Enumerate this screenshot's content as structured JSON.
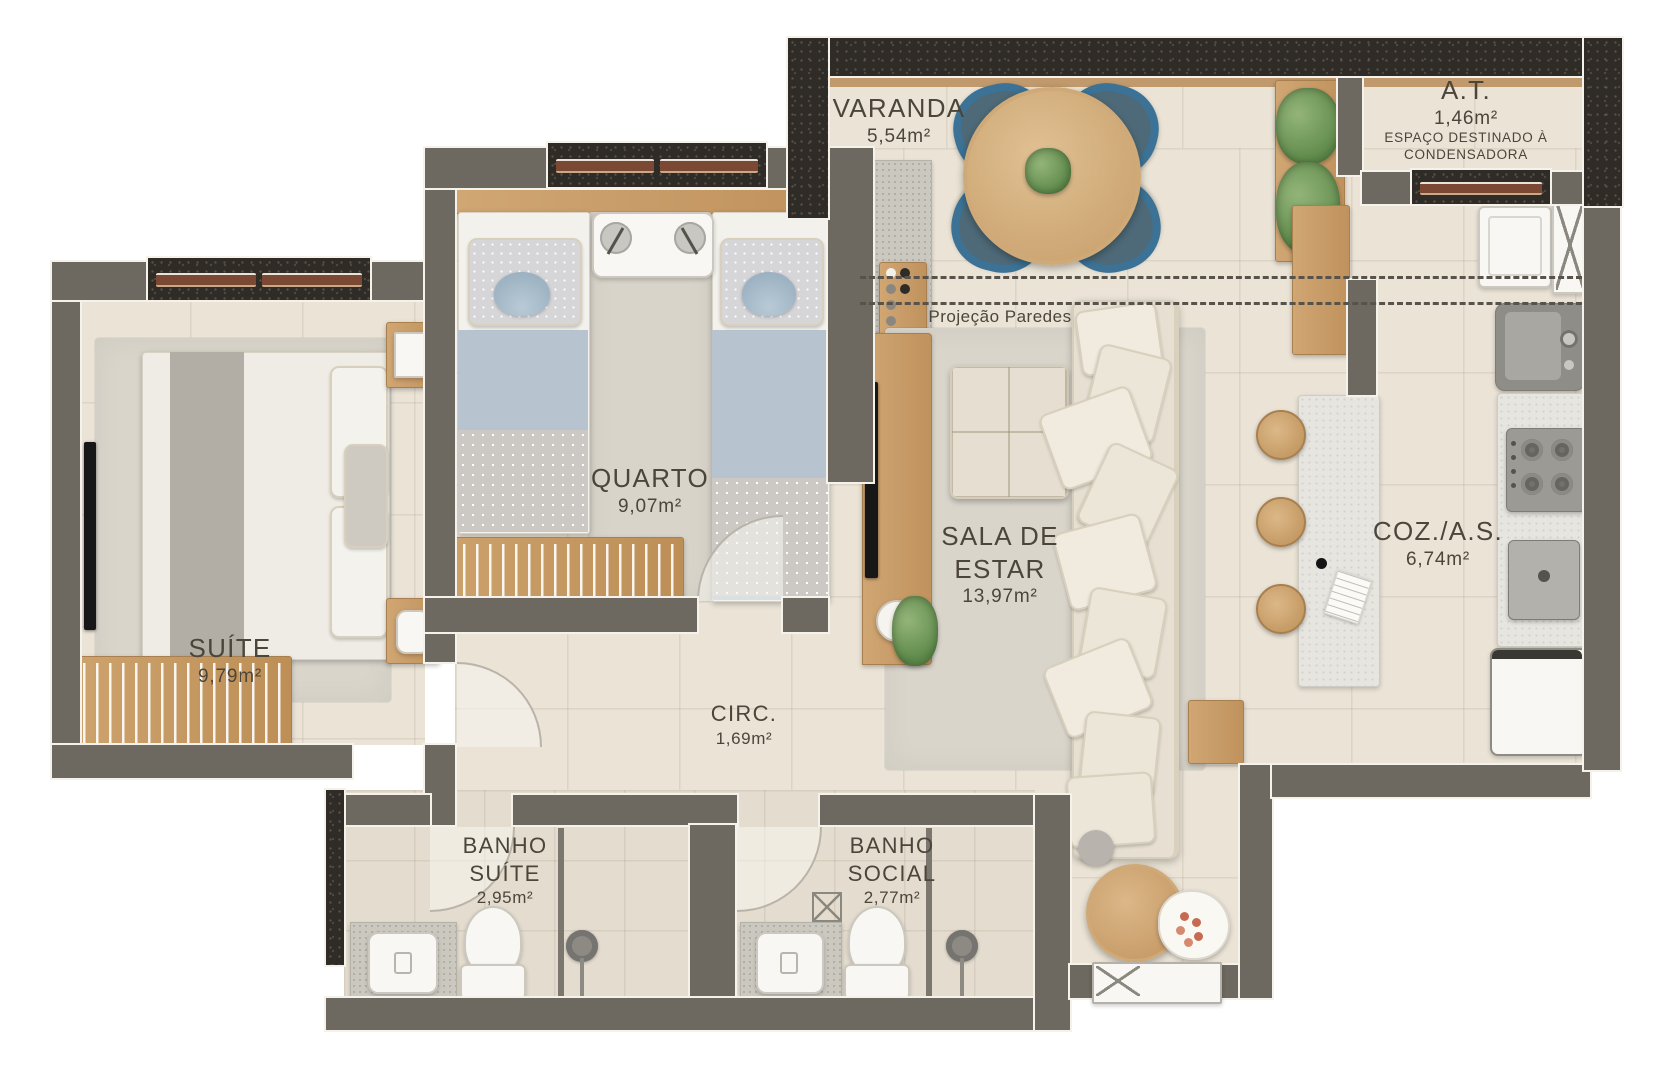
{
  "meta": {
    "type": "apartment-floor-plan",
    "units": "m²"
  },
  "labels": {
    "varanda": {
      "name": "VARANDA",
      "area": "5,54m²"
    },
    "at": {
      "name": "A.T.",
      "area": "1,46m²",
      "note1": "ESPAÇO DESTINADO À",
      "note2": "CONDENSADORA"
    },
    "quarto": {
      "name": "QUARTO",
      "area": "9,07m²"
    },
    "suite": {
      "name": "SUÍTE",
      "area": "9,79m²"
    },
    "sala": {
      "line1": "SALA DE",
      "line2": "ESTAR",
      "area": "13,97m²"
    },
    "coz": {
      "name": "COZ./A.S.",
      "area": "6,74m²"
    },
    "circ": {
      "name": "CIRC.",
      "area": "1,69m²"
    },
    "banho_suite": {
      "line1": "BANHO",
      "line2": "SUÍTE",
      "area": "2,95m²"
    },
    "banho_social": {
      "line1": "BANHO",
      "line2": "SOCIAL",
      "area": "2,77m²"
    },
    "projecao": {
      "text": "Projeção Paredes"
    }
  },
  "colors": {
    "wall_gray": "#6d6960",
    "wall_granite": "#2f2b26",
    "floor_beige": "#eae3d6",
    "rug_gray": "#d9d5cb",
    "wood": "#c89e6a",
    "chair_blue": "#3b7295",
    "text": "#4c453a",
    "fixture_white": "#f8f7f3",
    "plant_green": "#6f9a5a"
  }
}
